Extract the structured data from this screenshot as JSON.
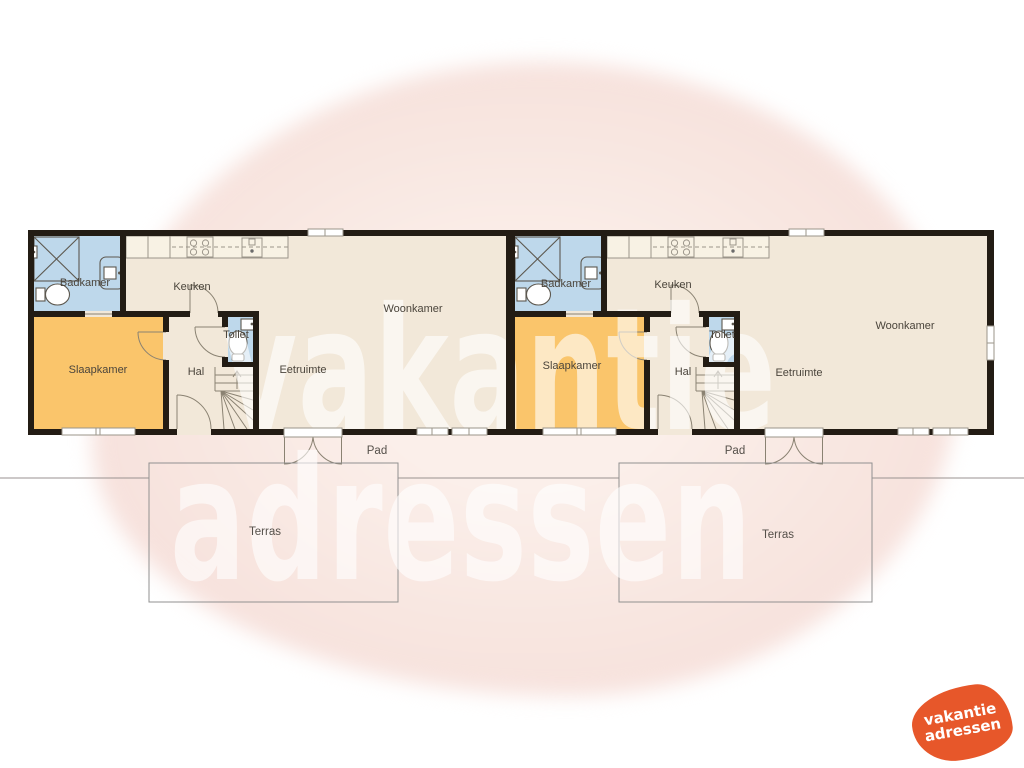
{
  "brand": {
    "watermark_line1": "vakantie",
    "watermark_line2": "adressen",
    "logo_line1": "vakantie",
    "logo_line2": "adressen"
  },
  "units": [
    {
      "name": "woning-links",
      "labels": {
        "badkamer": "Badkamer",
        "keuken": "Keuken",
        "woonkamer": "Woonkamer",
        "slaapkamer": "Slaapkamer",
        "hal": "Hal",
        "toilet": "Toilet",
        "eetruimte": "Eetruimte",
        "pad": "Pad",
        "terras": "Terras"
      }
    },
    {
      "name": "woning-rechts",
      "labels": {
        "badkamer": "Badkamer",
        "keuken": "Keuken",
        "woonkamer": "Woonkamer",
        "slaapkamer": "Slaapkamer",
        "hal": "Hal",
        "toilet": "Toilet",
        "eetruimte": "Eetruimte",
        "pad": "Pad",
        "terras": "Terras"
      }
    }
  ],
  "icons": {
    "shower": "crossed-square",
    "wc": "toilet-bowl",
    "washbasin": "basin-with-tap",
    "stove": "four-burner-hob",
    "sink": "kitchen-sink",
    "stairs": "winder-stairs-with-up-arrow",
    "door": "quarter-circle-swing",
    "french_door": "double-outswing-door",
    "window": "white-bar-in-wall"
  },
  "colors": {
    "wall": "#231C14",
    "floor": "#F2E8D9",
    "bedroom": "#FAC56B",
    "bathroom": "#BED8EB",
    "counter": "#F8F2E4",
    "terrace_line": "#909090",
    "background_blob": "#F8E6E0",
    "logo_orange": "#E7572A",
    "label_text": "#4B453C"
  }
}
